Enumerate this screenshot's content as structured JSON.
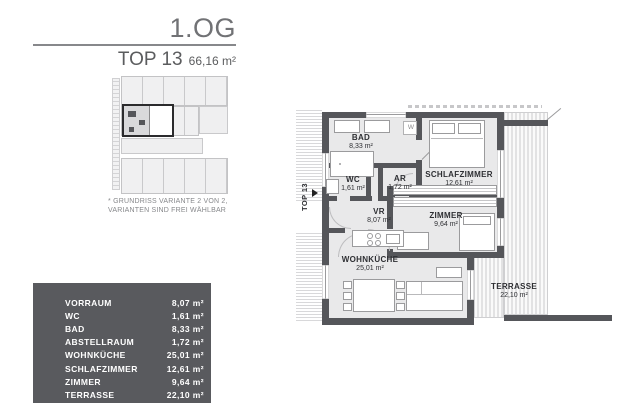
{
  "header": {
    "floor_label": "1.OG",
    "unit_label": "TOP 13",
    "unit_area": "66,16 m²"
  },
  "variant_note": {
    "line1": "* GRUNDRISS VARIANTE 2 VON 2,",
    "line2": "VARIANTEN SIND FREI WÄHLBAR"
  },
  "area_table": {
    "rows": [
      {
        "label": "VORRAUM",
        "value": "8,07 m²"
      },
      {
        "label": "WC",
        "value": "1,61 m²"
      },
      {
        "label": "BAD",
        "value": "8,33 m²"
      },
      {
        "label": "ABSTELLRAUM",
        "value": "1,72 m²"
      },
      {
        "label": "WOHNKÜCHE",
        "value": "25,01 m²"
      },
      {
        "label": "SCHLAFZIMMER",
        "value": "12,61 m²"
      },
      {
        "label": "ZIMMER",
        "value": "9,64 m²"
      },
      {
        "label": "TERRASSE",
        "value": "22,10 m²"
      }
    ]
  },
  "floor_plan": {
    "unit_tag": "TOP 13",
    "washer_label": "W",
    "rooms": [
      {
        "name": "BAD",
        "area": "8,33 m²"
      },
      {
        "name": "WC",
        "area": "1,61  m²"
      },
      {
        "name": "AR",
        "area": "1,72 m²"
      },
      {
        "name": "SCHLAFZIMMER",
        "area": "12,61  m²"
      },
      {
        "name": "VR",
        "area": "8,07 m²"
      },
      {
        "name": "ZIMMER",
        "area": "9,64 m²"
      },
      {
        "name": "WOHNKÜCHE",
        "area": "25,01 m²"
      },
      {
        "name": "TERRASSE",
        "area": "22,10 m²"
      }
    ]
  },
  "colors": {
    "wall": "#55565a",
    "room_fill": "#e9e9ea",
    "panel_bg": "#595a5e",
    "text_dark": "#2e2f33",
    "text_gray": "#87888b"
  }
}
